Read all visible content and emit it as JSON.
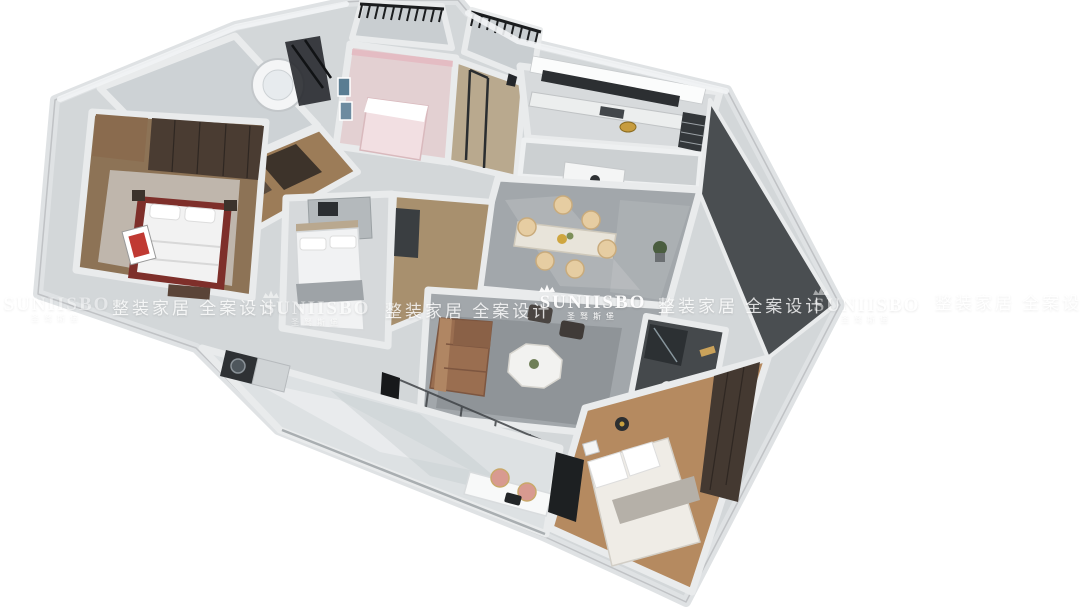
{
  "meta": {
    "kind": "3d-dollhouse-floorplan-render",
    "width": 1080,
    "height": 608,
    "background": "#ffffff"
  },
  "watermark": {
    "brand": "SUNIISBO",
    "brand_zh": "圣驽斯堡",
    "tagline": "整装家居 全案设计",
    "color": "#ffffff",
    "crown_icon": "crown",
    "row_center_y": 300
  },
  "brand_badge": {
    "shape": "gold-oval",
    "color": "#c79c3e",
    "location": "kitchen-counter"
  },
  "palette": {
    "slab": "#d3d7d9",
    "wall_top": "#e9ebec",
    "wall_edge": "#b2b5b8",
    "marble_gray": "#a2a7ab",
    "marble_light": "#dde1e3",
    "tile_light": "#cdd2d5",
    "wood_corridor": "#9c7c58",
    "wood_master": "#8d7356",
    "wood_warm": "#b58a60",
    "pink_floor": "#e3d0d2",
    "pink_bed": "#f2dfe2",
    "sofa_brown": "#9a6e50",
    "chair_cream": "#e6cda2",
    "chair_pink": "#d89a90",
    "glass_dark": "#26292c",
    "furniture_dark": "#3a3e41",
    "accent_red": "#8e3a32",
    "bath_dark": "#45494c",
    "rug_gray": "#8f9498",
    "white_furniture": "#f2f3f4"
  },
  "rooms": [
    {
      "name": "bathroom-top",
      "features": [
        "corner-bathtub",
        "shower-glass"
      ]
    },
    {
      "name": "kids-bedroom",
      "features": [
        "pink-bed",
        "pink-curtains",
        "wall-art"
      ]
    },
    {
      "name": "balcony-small-left",
      "features": [
        "metal-railing"
      ]
    },
    {
      "name": "entry-hall",
      "features": [
        "glass-door"
      ]
    },
    {
      "name": "balcony-small-right",
      "features": [
        "metal-railing"
      ]
    },
    {
      "name": "kitchen",
      "features": [
        "counter",
        "window-strip",
        "appliance-column",
        "gold-badge"
      ]
    },
    {
      "name": "dining-room",
      "features": [
        "dining-table",
        "six-cream-chairs",
        "sideboard",
        "plant"
      ]
    },
    {
      "name": "master-bedroom",
      "features": [
        "red-frame-bed",
        "wardrobe",
        "red-artwork",
        "rug"
      ]
    },
    {
      "name": "bedroom-middle",
      "features": [
        "white-bed",
        "vanity-desk",
        "gray-runner"
      ]
    },
    {
      "name": "corridor-wood",
      "features": [
        "dark-cabinets"
      ]
    },
    {
      "name": "living-room",
      "features": [
        "leather-sofa",
        "octagon-coffee-table",
        "ottomans",
        "rug",
        "glass-partition",
        "tv"
      ]
    },
    {
      "name": "bathroom-dark",
      "features": [
        "shower",
        "toilet",
        "gold-towel"
      ]
    },
    {
      "name": "bedroom-bottom-right",
      "features": [
        "bed",
        "wardrobe",
        "floor-lamp"
      ]
    },
    {
      "name": "balcony-long",
      "features": [
        "washing-machine",
        "white-desk",
        "two-pink-chairs",
        "laptop"
      ]
    }
  ]
}
